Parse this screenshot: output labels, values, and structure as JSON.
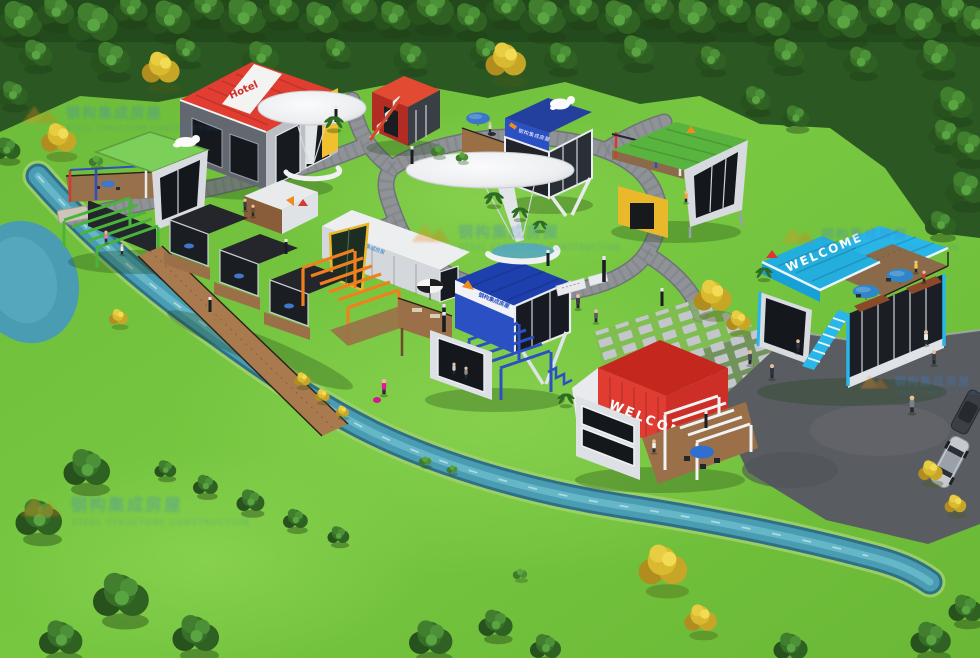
{
  "scene": {
    "type": "aerial-3d-architectural-render",
    "subject": "Container-house leisure park with lawns, forest border, winding stream, stone paths and colorful modular container buildings",
    "signs": {
      "hotel": "Hotel",
      "welcome": "WELCOME"
    },
    "brand": {
      "logo": "orange-double-roof-house-logo",
      "name_cn": "钢构集成房屋",
      "name_en": "STEEL STRUCTURE CONSTRUCTION"
    },
    "palette": {
      "grass": "#74c43e",
      "forest_green": "#2b5722",
      "autumn_yellow": "#d9b92f",
      "water_teal": "#4a9cb2",
      "path_gray": "#8f9398",
      "asphalt_gray": "#595c61",
      "container_red": "#e03c31",
      "container_blue": "#2b50c4",
      "container_cyan": "#29b7e9",
      "container_green": "#58b43e",
      "container_orange": "#f07f1e",
      "container_yellow": "#e9b82b",
      "deck_wood": "#9b7049",
      "panel_white": "#e9ebee",
      "glass_dark": "#171b21"
    },
    "buildings": [
      {
        "name": "red-white-hotel",
        "sign": "Hotel"
      },
      {
        "name": "orange-container-with-stairs"
      },
      {
        "name": "blue-rooftop-cafe-container"
      },
      {
        "name": "green-roof-viewpoint-container"
      },
      {
        "name": "green-pergola-terrace-pavilion"
      },
      {
        "name": "dark-glass-guest-rooms"
      },
      {
        "name": "white-brand-container"
      },
      {
        "name": "blue-center-pavilion"
      },
      {
        "name": "cyan-welcome-restaurant",
        "sign": "WELCOME"
      },
      {
        "name": "red-welcome-cabin",
        "sign": "WELCOME"
      }
    ],
    "landscape": [
      "pine-forest-border",
      "autumn-yellow-trees",
      "winding-stream",
      "cobblestone-paths",
      "stepping-stone-plaza",
      "mushroom-canopy-pavilions",
      "crescent-benches",
      "palm-shrubs",
      "asphalt-parking-lot"
    ],
    "figures": {
      "pedestrians": 18,
      "silver_car": 1,
      "dark_car": 1
    }
  }
}
